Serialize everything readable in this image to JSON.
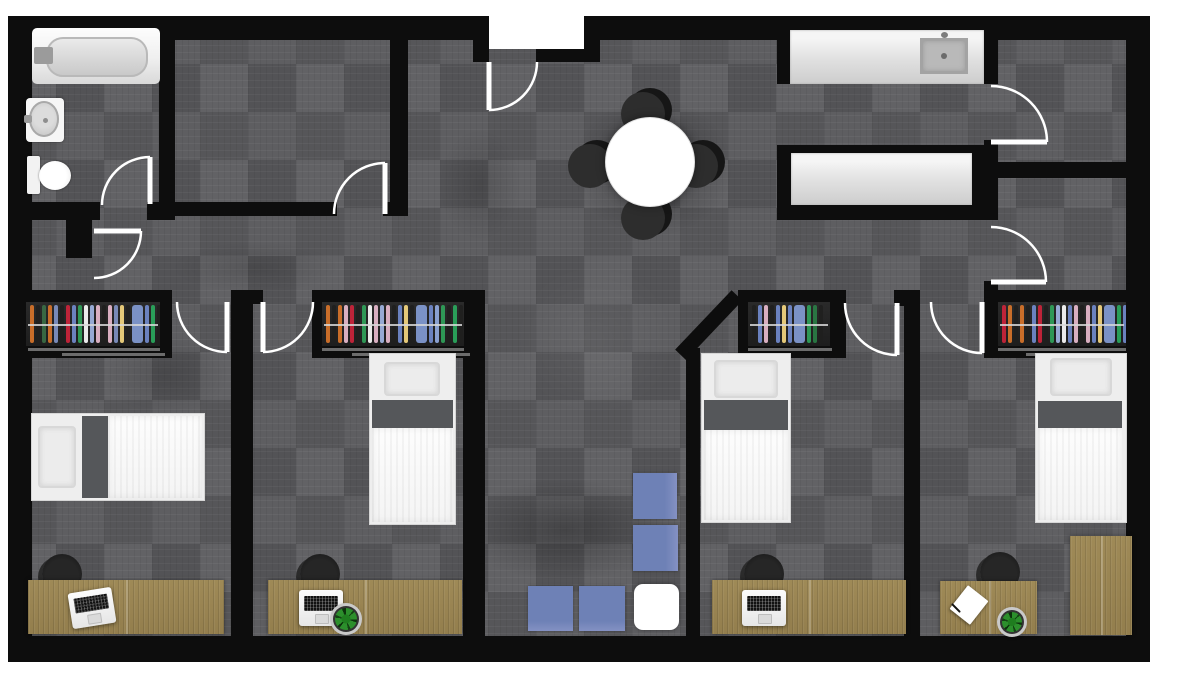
{
  "app": {
    "type": "floor-plan-render",
    "description": "Top-down 2D rendered floor plan of a four-bedroom apartment with shared kitchen, dining and living areas"
  },
  "palette": {
    "wall": "#0d0d0d",
    "carpet_base": "#58585b",
    "wood": "#9f8a57",
    "counter_white": "#e9e9e9",
    "fixture_white": "#fafafa",
    "sofa_blue": "#6e81b6",
    "ottoman_white": "#ffffff",
    "bed_band": "#55575a",
    "chair_black": "#1b1b1b",
    "door_line": "#ffffff",
    "plant_green": "#2c8f2c",
    "hanger_rod": "#d7d7d7"
  },
  "rooms": [
    {
      "id": "bathroom",
      "furniture": [
        "bathtub",
        "pedestal-sink",
        "toilet"
      ]
    },
    {
      "id": "storage-room",
      "furniture": []
    },
    {
      "id": "entry-hall",
      "furniture": [
        "entry-door"
      ]
    },
    {
      "id": "kitchen",
      "furniture": [
        "counter-with-sink",
        "counter-peninsula"
      ]
    },
    {
      "id": "dining-area",
      "furniture": [
        "round-dining-table",
        "dining-chair x4"
      ]
    },
    {
      "id": "living-area",
      "furniture": [
        "sofa-module x4",
        "white-ottoman"
      ]
    },
    {
      "id": "room-right-top",
      "furniture": []
    },
    {
      "id": "room-right-mid",
      "furniture": []
    },
    {
      "id": "bedroom-1",
      "furniture": [
        "closet-with-hangers",
        "twin-bed",
        "wood-desk",
        "desk-chair",
        "laptop"
      ]
    },
    {
      "id": "bedroom-2",
      "furniture": [
        "closet-with-hangers",
        "twin-bed",
        "wood-desk",
        "desk-chair",
        "laptop",
        "potted-plant"
      ]
    },
    {
      "id": "bedroom-3",
      "furniture": [
        "closet-with-hangers",
        "twin-bed",
        "wood-desk",
        "desk-chair",
        "laptop"
      ]
    },
    {
      "id": "bedroom-4",
      "furniture": [
        "closet-with-hangers",
        "twin-bed",
        "wood-desk",
        "desk-chair",
        "notepad",
        "pen",
        "potted-plant",
        "wood-side-table"
      ]
    }
  ],
  "closets": {
    "bedroom_1": {
      "hangers": [
        [
          "#d2722a",
          4
        ],
        [
          "#20201f",
          4
        ],
        [
          "#3a6b45",
          4
        ],
        [
          "#d2722a",
          4
        ],
        [
          "#7d8fc0",
          4
        ],
        [
          "#20201f",
          4
        ],
        [
          "#c6243a",
          4
        ],
        [
          "#6f87c7",
          4
        ],
        [
          "#2f9e58",
          4
        ],
        [
          "#f5f5f5",
          4
        ],
        [
          "#9db1dd",
          4
        ],
        [
          "#e3b6c9",
          4
        ],
        [
          "#20201f",
          4
        ],
        [
          "#e3b6c9",
          4
        ],
        [
          "#7d8fc0",
          4
        ],
        [
          "#efd27d",
          4
        ],
        [
          "#20201f",
          4
        ],
        [
          "#7f98cf",
          11
        ],
        [
          "#6f87c7",
          4
        ],
        [
          "#2aa45c",
          4
        ],
        [
          "#20201f",
          4
        ]
      ]
    },
    "bedroom_2": {
      "hangers": [
        [
          "#d2722a",
          4
        ],
        [
          "#20201f",
          4
        ],
        [
          "#d2722a",
          4
        ],
        [
          "#e3b6c9",
          4
        ],
        [
          "#c6243a",
          4
        ],
        [
          "#20201f",
          4
        ],
        [
          "#2f9e58",
          4
        ],
        [
          "#f5f5f5",
          4
        ],
        [
          "#e3b6c9",
          4
        ],
        [
          "#9db1dd",
          4
        ],
        [
          "#e3b6c9",
          4
        ],
        [
          "#20201f",
          4
        ],
        [
          "#6f87c7",
          4
        ],
        [
          "#efd27d",
          4
        ],
        [
          "#20201f",
          4
        ],
        [
          "#7f98cf",
          11
        ],
        [
          "#6f87c7",
          4
        ],
        [
          "#8fa7d9",
          4
        ],
        [
          "#2f9e58",
          4
        ],
        [
          "#20201f",
          4
        ],
        [
          "#2aa45c",
          4
        ],
        [
          "#20201f",
          4
        ]
      ]
    },
    "bedroom_3": {
      "hangers": [
        [
          "#20201f",
          4
        ],
        [
          "#6f87c7",
          4
        ],
        [
          "#e3b6c9",
          4
        ],
        [
          "#20201f",
          4
        ],
        [
          "#6f87c7",
          4
        ],
        [
          "#efd27d",
          4
        ],
        [
          "#6f87c7",
          4
        ],
        [
          "#7f98cf",
          11
        ],
        [
          "#2f9e58",
          4
        ],
        [
          "#2a7a45",
          4
        ],
        [
          "#20201f",
          4
        ]
      ]
    },
    "bedroom_4": {
      "hangers": [
        [
          "#c6243a",
          4
        ],
        [
          "#d2722a",
          4
        ],
        [
          "#20201f",
          4
        ],
        [
          "#d2722a",
          4
        ],
        [
          "#20201f",
          4
        ],
        [
          "#6f87c7",
          4
        ],
        [
          "#c6243a",
          4
        ],
        [
          "#20201f",
          4
        ],
        [
          "#2f9e58",
          4
        ],
        [
          "#9db1dd",
          4
        ],
        [
          "#f5f5f5",
          4
        ],
        [
          "#6f87c7",
          4
        ],
        [
          "#e3b6c9",
          4
        ],
        [
          "#20201f",
          4
        ],
        [
          "#e3b6c9",
          4
        ],
        [
          "#6f87c7",
          4
        ],
        [
          "#efd27d",
          4
        ],
        [
          "#7f98cf",
          11
        ],
        [
          "#2aa45c",
          4
        ],
        [
          "#6f87c7",
          4
        ],
        [
          "#20201f",
          4
        ]
      ]
    }
  },
  "doors": [
    "entry-door",
    "bathroom-door",
    "storage-room-door",
    "hall-door",
    "bedroom-1-door",
    "bedroom-2-door",
    "bedroom-3-door",
    "bedroom-4-door",
    "kitchen-side-door",
    "room-right-mid-door"
  ]
}
